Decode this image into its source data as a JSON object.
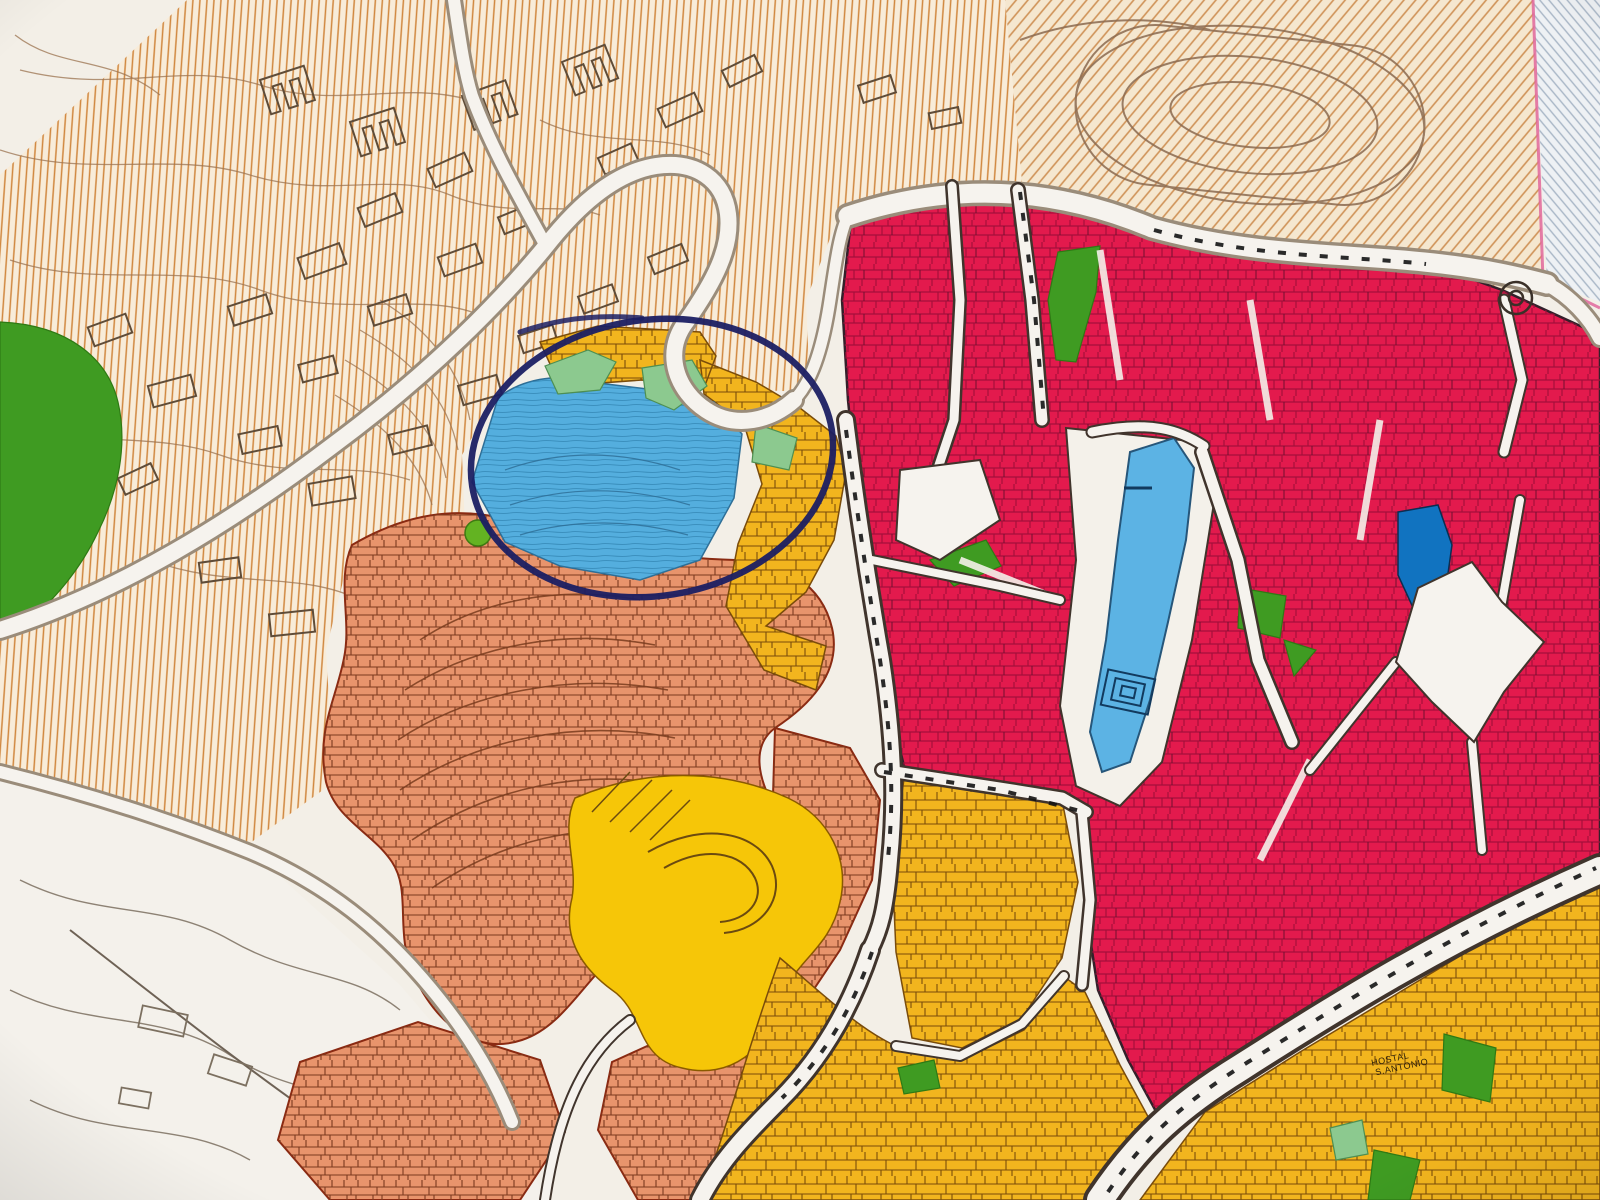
{
  "meta": {
    "title": "Urban zoning map photograph with hand-drawn navy circle annotation",
    "description": "Colour-coded town planning map: hatched hillside zones, crimson historic core, yellow and salmon districts, blue and green areas, white roads; a navy pen ellipse highlights a blue/yellow hillside district"
  },
  "labels": {
    "hostal_line1": "HOSTAL",
    "hostal_line2": "S.ANTONIO"
  },
  "palette": {
    "paper": "#f3efe7",
    "white_area": "#f4f1eb",
    "hatch_bg": "#f8ecd9",
    "hatch_line": "#d0873e",
    "hatch_diag_bg": "#f5e7cf",
    "hatch_diag_line": "#cf9257",
    "hatch_bluegray_bg": "#eef1f4",
    "hatch_bluegray_line": "#a8b6c6",
    "boundary_pink": "#e0679b",
    "contour_brown": "#9b7350",
    "contour_gray": "#8d8274",
    "building_outline": "#5f4c38",
    "park_green_dark": "#3f9b22",
    "park_green_light": "#8cc98f",
    "park_green_dot": "#63b322",
    "zone_blue": "#54aede",
    "zone_blue_park": "#5cb3e4",
    "zone_blue_dark": "#1173c0",
    "zone_yellow": "#f2b51e",
    "zone_yellow_bright": "#f6c608",
    "zone_salmon": "#e8946c",
    "zone_crimson": "#e31a4d",
    "road_casing_soft": "#9a8c7a",
    "road_casing_dark": "#40342c",
    "road_dash": "#141414",
    "annotation_navy": "#1b1f63"
  },
  "zones": [
    {
      "id": "hatched-hillside-nw",
      "color": "#f8ecd9",
      "texture": "vertical orange hatching, contour lines, building outlines"
    },
    {
      "id": "hatched-sports-ne",
      "color": "#f5e7cf",
      "texture": "diagonal orange hatching with stadium track ovals"
    },
    {
      "id": "hatched-bluegray-corner",
      "color": "#eef1f4",
      "texture": "diagonal blue-grey hatching behind pink boundary"
    },
    {
      "id": "west-park-strip",
      "color": "#3f9b22"
    },
    {
      "id": "circled-blue-district",
      "color": "#54aede"
    },
    {
      "id": "circled-yellow-district",
      "color": "#f2b51e"
    },
    {
      "id": "circled-light-green-patches",
      "color": "#8cc98f"
    },
    {
      "id": "salmon-old-quarter",
      "color": "#e8946c"
    },
    {
      "id": "bright-yellow-district",
      "color": "#f6c608"
    },
    {
      "id": "crimson-historic-core",
      "color": "#e31a4d"
    },
    {
      "id": "yellow-districts-south",
      "color": "#f2b51e"
    },
    {
      "id": "blue-park-promenade",
      "color": "#5cb3e4"
    },
    {
      "id": "dark-blue-plot",
      "color": "#1173c0"
    },
    {
      "id": "city-green-patches",
      "color": "#3da32c"
    },
    {
      "id": "white-slope-sw",
      "color": "#f4f1eb",
      "texture": "contour squiggles and building outlines"
    }
  ],
  "annotation": {
    "type": "hand-drawn ellipse",
    "color": "#1b1f63",
    "center_x": 652,
    "center_y": 458,
    "note": "navy pen circle highlighting the blue and yellow hillside district"
  }
}
